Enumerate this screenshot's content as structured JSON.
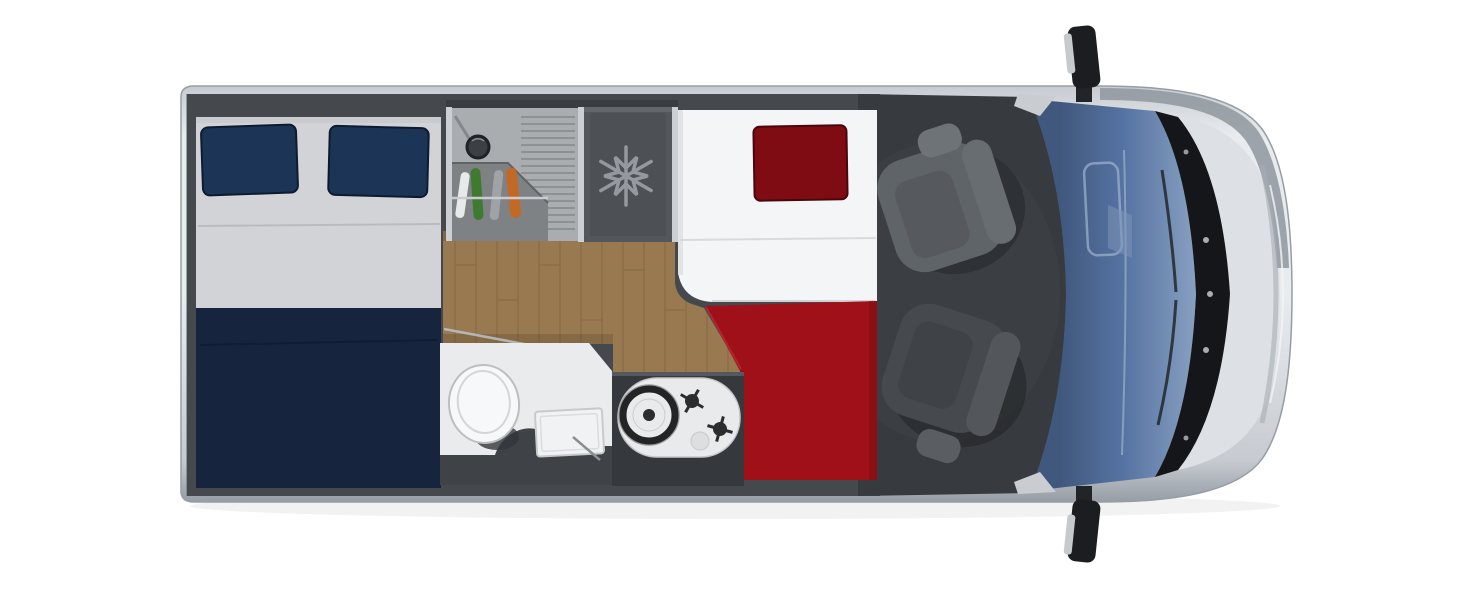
{
  "components": {
    "vehicle": "Campervan top-view floor plan",
    "bodyShell": "Van body shell",
    "rearBed": "Rear double bed",
    "rearPillowLeft": "Navy pillow left",
    "rearPillowRight": "Navy pillow right",
    "kitchen": "Kitchen unit with round sink and drainer",
    "kitchenSink": "Round kitchen sink",
    "fridge": "Fridge compartment",
    "snowflake": "Snowflake icon",
    "corridor": "Wooden floor walkway",
    "bathroom": "Bathroom with toilet and basin",
    "toilet": "Toilet",
    "basin": "Shower basin",
    "hob": "Gas hob with two burners",
    "singleBed": "Single bed with red bedding",
    "redPillow": "Dark red pillow",
    "redBlanket": "Red blanket",
    "cabFloor": "Driver cab floor",
    "seatPassenger": "Passenger swivel seat",
    "seatDriver": "Driver swivel seat",
    "windshield": "Windscreen",
    "cowl": "Wiper cowl",
    "hood": "Bonnet",
    "mirrorTop": "Side mirror upper",
    "mirrorBottom": "Side mirror lower"
  },
  "palette": {
    "bodySilver": "#c7cbd1",
    "bodyLight": "#e9ecef",
    "bodyEdge": "#969da5",
    "wallDark": "#45484d",
    "cabFloor": "#373a3e",
    "bedSheet": "#d2d3d6",
    "bedSheetSeam": "#b9bcbf",
    "bedNavy": "#16243e",
    "pillowNavy": "#1c3456",
    "pillowNavyEdge": "#0d1b31",
    "woodBase": "#997950",
    "woodLine": "#7c6040",
    "counter": "#a9adb0",
    "counterRidge": "#8d9194",
    "cabinet": "#7e8285",
    "dividerLight": "#ccd0d4",
    "fridge": "#53575b",
    "fridgeInner": "#4d5155",
    "snowflake": "#9499a0",
    "bedWhite": "#f4f5f6",
    "pillowRed": "#7f0c13",
    "pillowRedEdge": "#4a060b",
    "blanketRed": "#a01018",
    "blanketRedShade": "#7c0b12",
    "bathFloor": "#e9ebec",
    "bathDark": "#3f4246",
    "toiletWhite": "#f7f8f9",
    "hobDark": "#35383c",
    "cooktopWhite": "#e9eaeb",
    "burnerDark": "#222426",
    "seatTop": "#5f6468",
    "seatTopBack": "#686d71",
    "seatTopHead": "#6e7377",
    "seatTopInset": "#565a5e",
    "seatBottom": "#46494d",
    "seatBottomBack": "#53575b",
    "seatBottomHead": "#5a5e62",
    "seatBottomInset": "#3f4246",
    "windshieldDark": "#41587e",
    "windshieldMid": "#5573a2",
    "windshieldLight": "#8aa2c2",
    "cowl": "#141619",
    "hoodLight": "#dde1e5",
    "hoodShade": "#8f969e",
    "mirrorDark": "#1b1d20",
    "mirrorGlass": "#c6cacd",
    "greenBottle": "#3e7a30",
    "orangeItem": "#c26a25"
  }
}
